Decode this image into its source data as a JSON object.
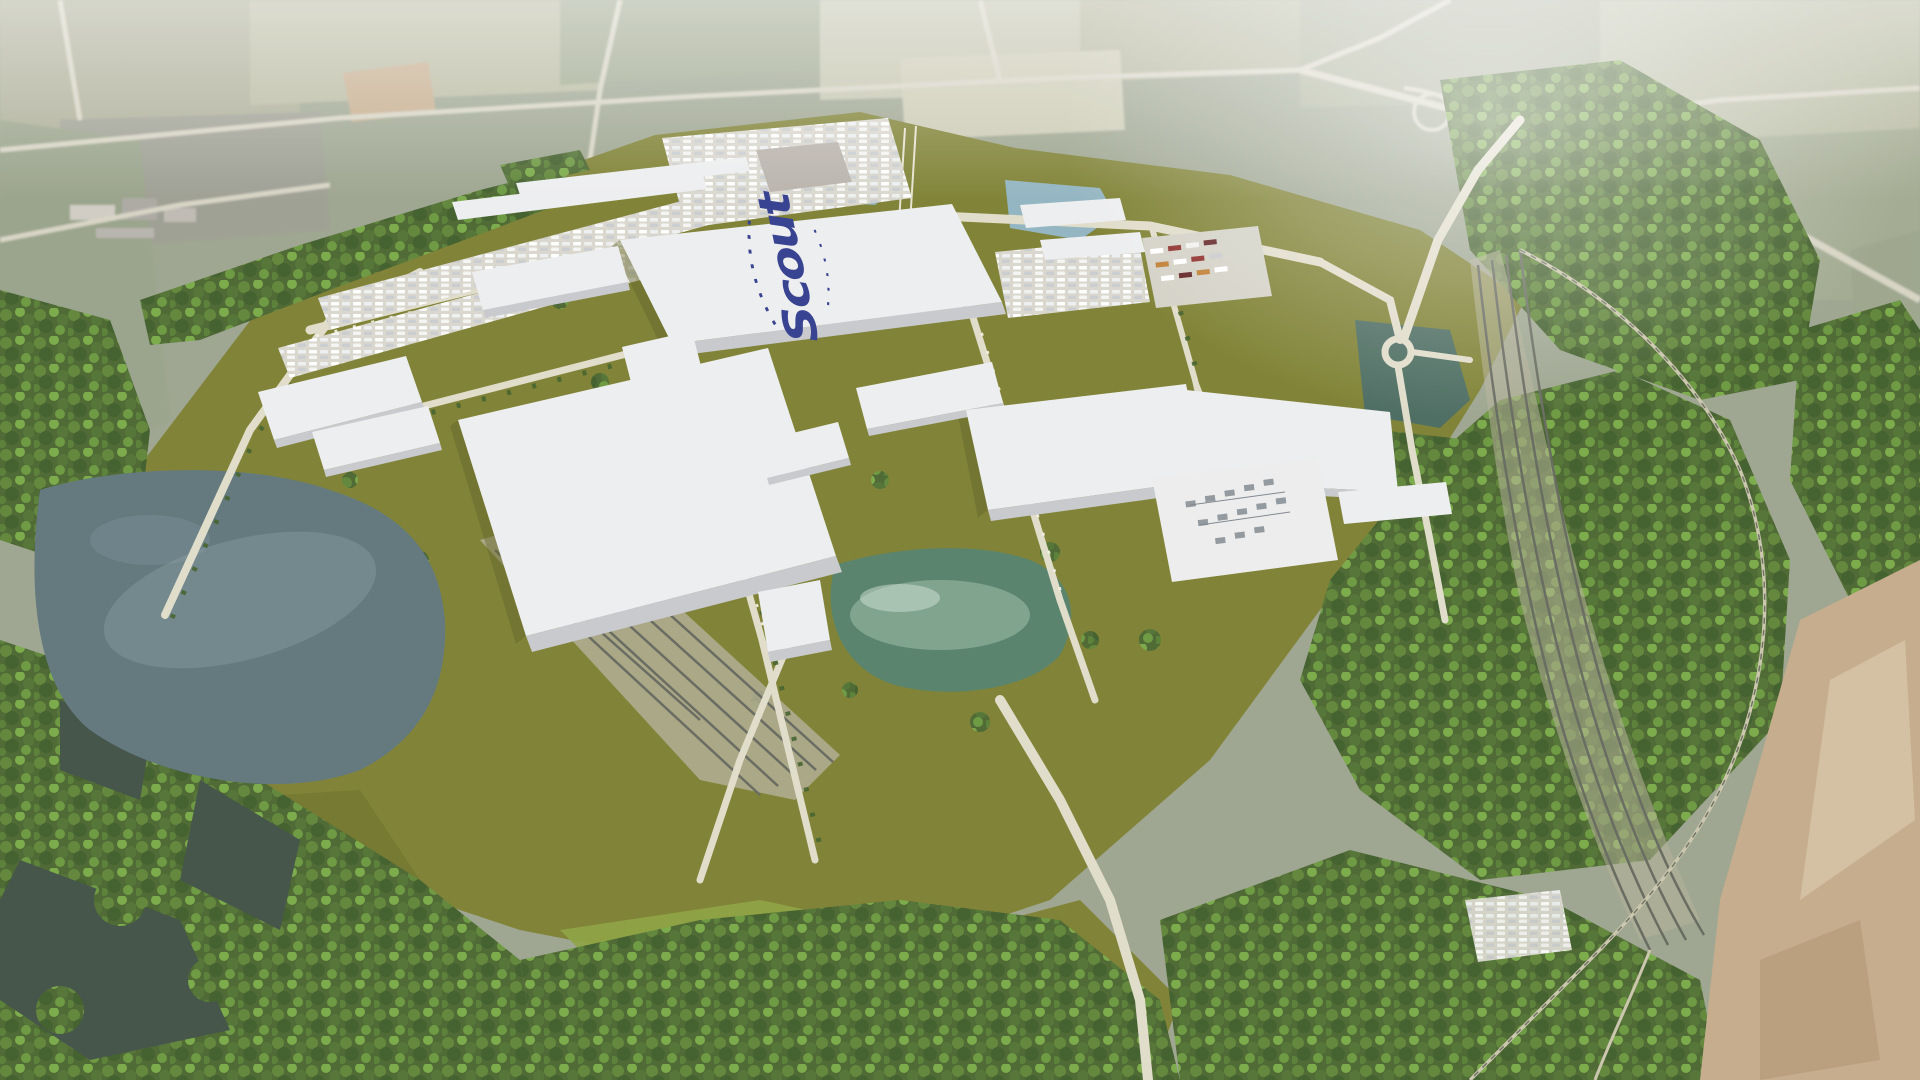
{
  "scene": {
    "description_label": "aerial-3d-rendering-of-ev-factory-campus"
  },
  "roof_logo": {
    "script_text": "Scout",
    "color": "#2e3a8c"
  },
  "palette": {
    "aerial_base": "#9aa28c",
    "aerial_light": "#b8b9a1",
    "aerial_pale": "#c9c9b4",
    "aerial_dark": "#7e8a74",
    "aerial_road": "#d6d3c2",
    "campus": "#7b7e2e",
    "campus_dark": "#6d7026",
    "grass_bright": "#8aa03c",
    "forest_base": "#47642b",
    "water_lake": "#5c7379",
    "water_lake_hi": "#8ba1a6",
    "pond_teal": "#527e66",
    "pond_teal_hi": "#a3c2ad",
    "pond_blue": "#8fb3bf",
    "pond_dark": "#47685c",
    "wetland_dark": "#3e4d42",
    "roof_top": "#edeeef",
    "roof_side": "#c6c8cc",
    "road": "#e0dcc9",
    "railbed": "#b3ae96",
    "rail_dark": "#63665a",
    "pad_gray": "#b7b1a9",
    "equip_gray": "#8e959b",
    "sand": "#c3a988",
    "truck_red": "#8c2a26",
    "truck_dark_red": "#5f1d1e",
    "truck_orange": "#bf7c2f",
    "haze": "#ffffff"
  }
}
